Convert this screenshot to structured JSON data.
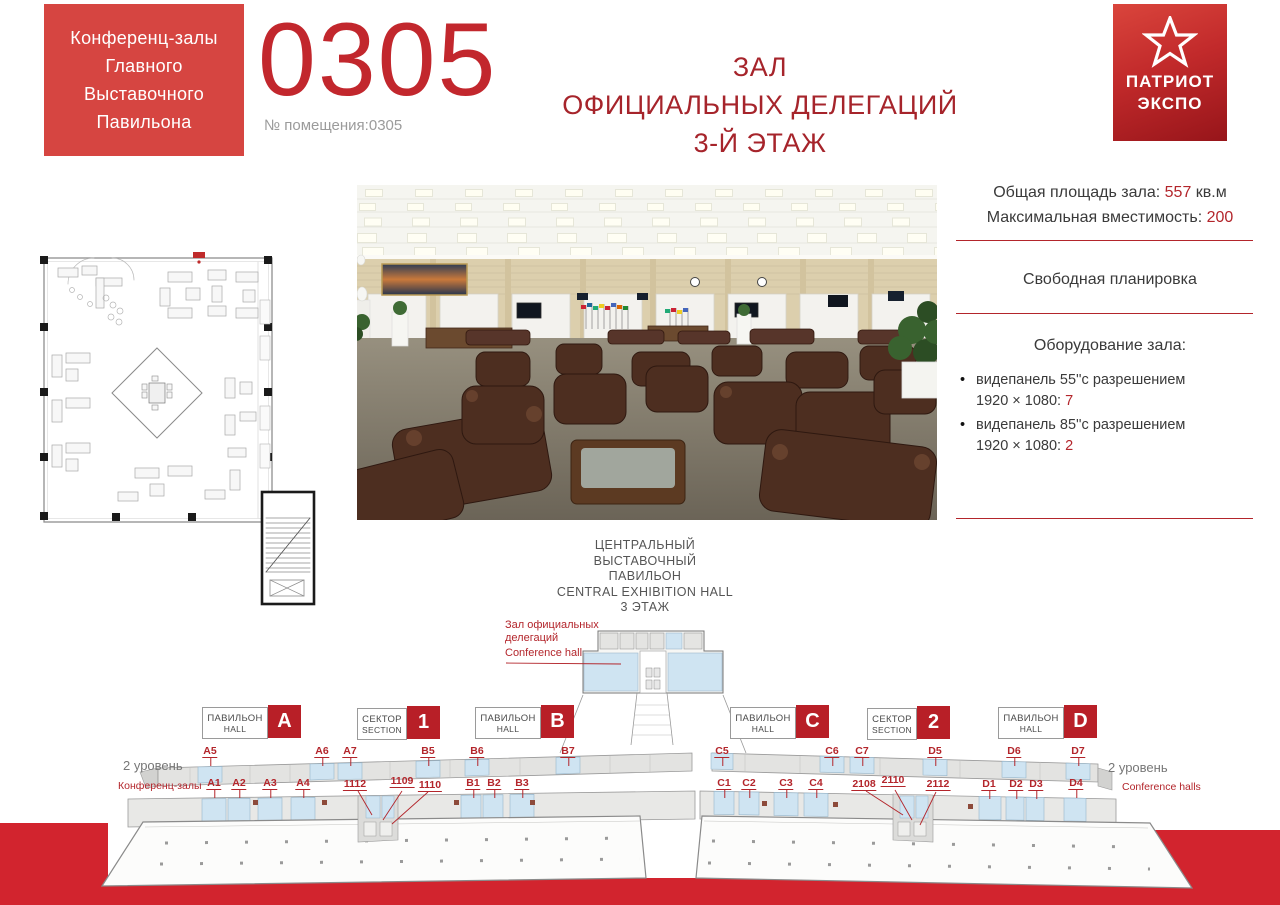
{
  "colors": {
    "brand_red": "#c2272d",
    "title_red": "#a6242b",
    "badge_red": "#b81f27",
    "band_red": "#d2242e",
    "label_red": "#b3252b",
    "blue_cell": "#cfe4f2"
  },
  "header": {
    "box_lines": [
      "Конференц-залы",
      "Главного",
      "Выставочного",
      "Павильона"
    ],
    "room_number": "0305",
    "room_caption": "№ помещения:0305",
    "title_lines": [
      "ЗАЛ",
      "ОФИЦИАЛЬНЫХ ДЕЛЕГАЦИЙ",
      "3-Й ЭТАЖ"
    ],
    "logo": {
      "line1": "ПАТРИОТ",
      "line2": "ЭКСПО",
      "icon": "star-icon"
    }
  },
  "info": {
    "area_label": "Общая площадь зала:",
    "area_value": "557",
    "area_unit": "кв.м",
    "capacity_label": "Максимальная вместимость:",
    "capacity_value": "200",
    "layout": "Свободная планировка",
    "equipment_title": "Оборудование зала:",
    "equipment": [
      {
        "name": "видепанель 55''с разрешением",
        "resolution": "1920 × 1080:",
        "count": "7"
      },
      {
        "name": "видепанель 85''с разрешением",
        "resolution": "1920 × 1080:",
        "count": "2"
      }
    ]
  },
  "central": {
    "title_lines": [
      "ЦЕНТРАЛЬНЫЙ",
      "ВЫСТАВОЧНЫЙ",
      "ПАВИЛЬОН",
      "CENTRAL EXHIBITION HALL",
      "3 ЭТАЖ"
    ],
    "hall_ru": "Зал официальных делегаций",
    "hall_en": "Conference hall"
  },
  "badges": [
    {
      "ru": "ПАВИЛЬОН",
      "en": "HALL",
      "letter": "A"
    },
    {
      "ru": "СЕКТОР",
      "en": "SECTION",
      "letter": "1"
    },
    {
      "ru": "ПАВИЛЬОН",
      "en": "HALL",
      "letter": "B"
    },
    {
      "ru": "ПАВИЛЬОН",
      "en": "HALL",
      "letter": "C"
    },
    {
      "ru": "СЕКТОР",
      "en": "SECTION",
      "letter": "2"
    },
    {
      "ru": "ПАВИЛЬОН",
      "en": "HALL",
      "letter": "D"
    }
  ],
  "left_wing": {
    "level": "2 уровень",
    "conf": "Конференц-залы",
    "upper": [
      "A5",
      "A6",
      "A7",
      "B5",
      "B6",
      "B7"
    ],
    "lower": [
      "A1",
      "A2",
      "A3",
      "A4",
      "1112",
      "1109",
      "1110",
      "B1",
      "B2",
      "B3"
    ]
  },
  "right_wing": {
    "level": "2 уровень",
    "conf": "Conference halls",
    "upper": [
      "C5",
      "C6",
      "C7",
      "D5",
      "D6",
      "D7"
    ],
    "lower": [
      "C1",
      "C2",
      "C3",
      "C4",
      "2108",
      "2110",
      "2112",
      "D1",
      "D2",
      "D3",
      "D4"
    ]
  }
}
